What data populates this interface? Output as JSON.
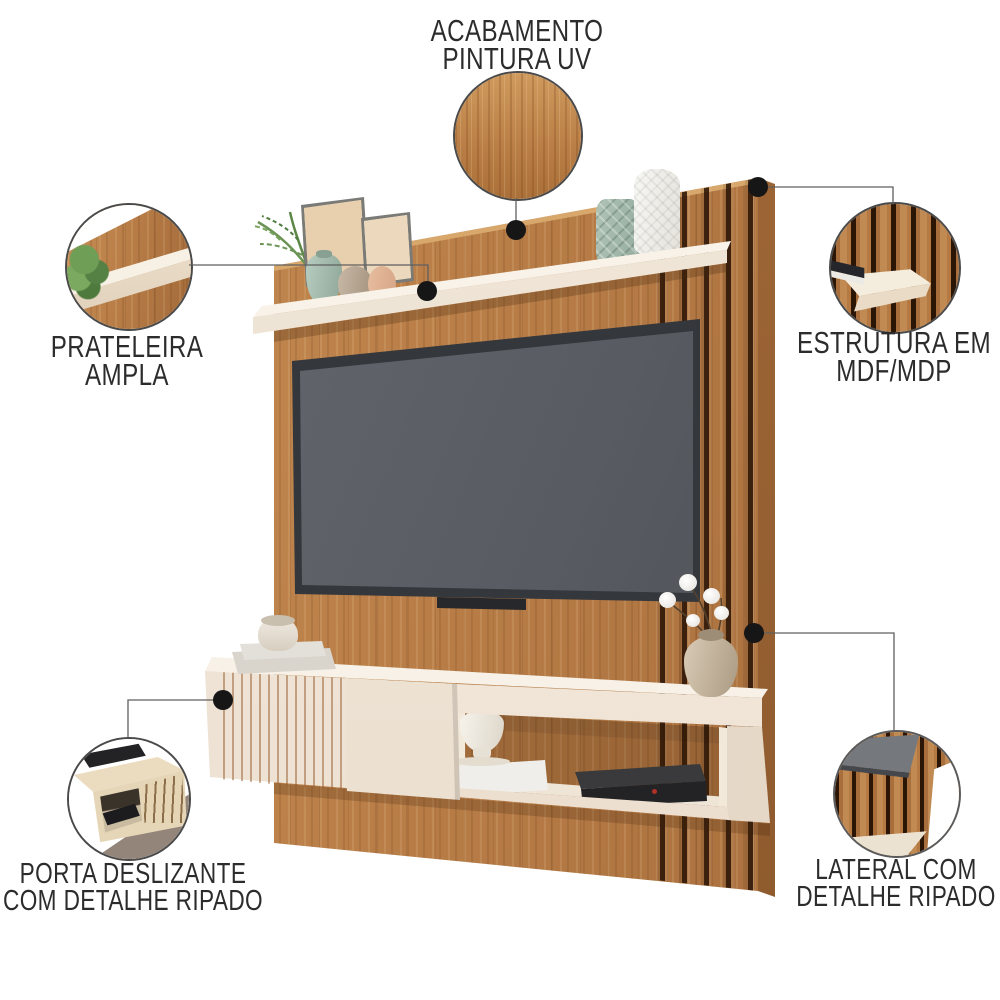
{
  "figure": {
    "type": "product-feature-callout-diagram",
    "subject": "tv-wall-panel"
  },
  "callouts": {
    "finish": {
      "line1": "ACABAMENTO",
      "line2": "PINTURA UV"
    },
    "shelf": {
      "line1": "PRATELEIRA",
      "line2": "AMPLA"
    },
    "structure": {
      "line1": "ESTRUTURA EM",
      "line2": "MDF/MDP"
    },
    "sliding_door": {
      "line1": "PORTA DESLIZANTE",
      "line2": "COM DETALHE RIPADO"
    },
    "side_panel": {
      "line1": "LATERAL COM",
      "line2": "DETALHE RIPADO"
    }
  },
  "colors": {
    "background": "#ffffff",
    "wood": "#b87c45",
    "wood_dark": "#8a5527",
    "slat_gap": "#2e1808",
    "cream": "#f1e8db",
    "tv_frame": "#34373c",
    "tv_screen": "#585c62",
    "callout_text": "#2c2c2c",
    "callout_line": "#5f5f5f",
    "callout_dot": "#161616",
    "plant_green": "#6f9e57",
    "sage_vase": "#a7bdaf",
    "taupe_floor": "#93857a"
  }
}
